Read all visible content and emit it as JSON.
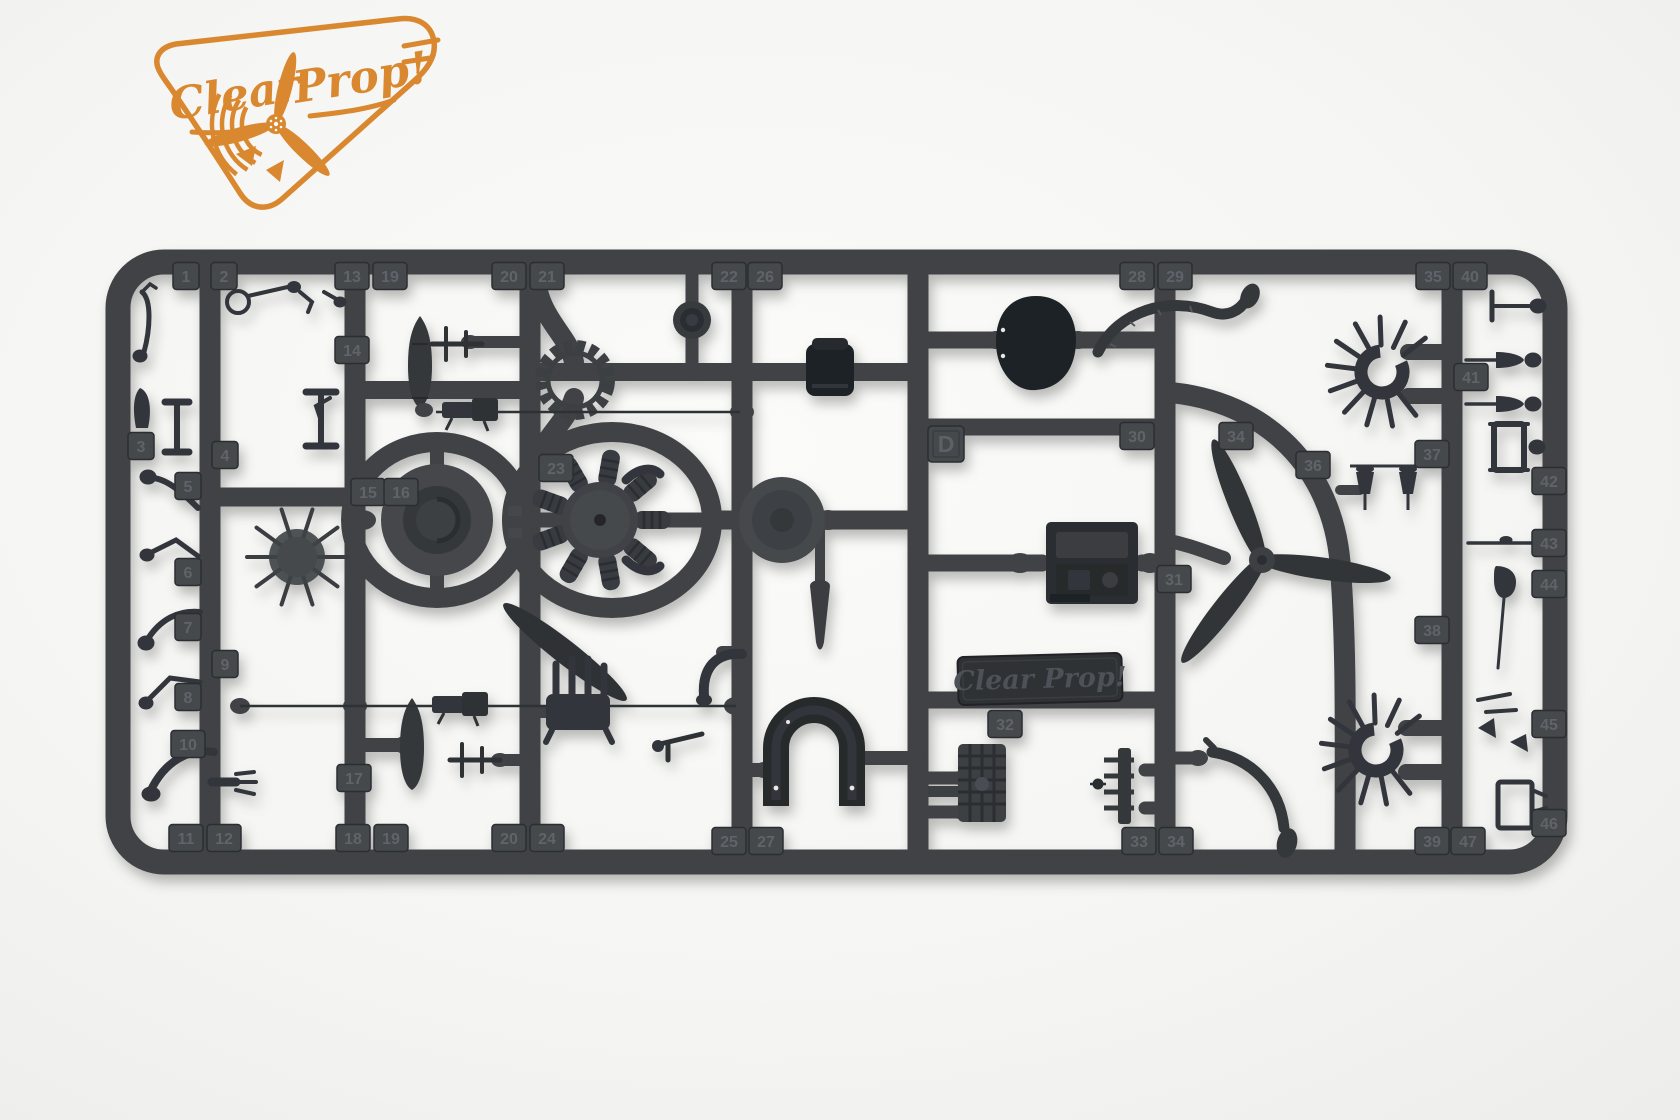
{
  "meta": {
    "image_type": "product-photo-model-kit-sprue"
  },
  "logo": {
    "word1": "Clear",
    "word2": "Prop!",
    "color": "#d9882f"
  },
  "sprue": {
    "letter": "D",
    "nameplate_text": "Clear Prop!",
    "tabs": [
      {
        "n": "1",
        "x": 186,
        "y": 276
      },
      {
        "n": "2",
        "x": 224,
        "y": 276
      },
      {
        "n": "13",
        "x": 352,
        "y": 276
      },
      {
        "n": "19",
        "x": 390,
        "y": 276
      },
      {
        "n": "20",
        "x": 509,
        "y": 276
      },
      {
        "n": "21",
        "x": 547,
        "y": 276
      },
      {
        "n": "22",
        "x": 729,
        "y": 276
      },
      {
        "n": "26",
        "x": 765,
        "y": 276
      },
      {
        "n": "28",
        "x": 1137,
        "y": 276
      },
      {
        "n": "29",
        "x": 1175,
        "y": 276
      },
      {
        "n": "35",
        "x": 1433,
        "y": 276
      },
      {
        "n": "40",
        "x": 1470,
        "y": 276
      },
      {
        "n": "3",
        "x": 141,
        "y": 446
      },
      {
        "n": "4",
        "x": 225,
        "y": 455
      },
      {
        "n": "5",
        "x": 188,
        "y": 486
      },
      {
        "n": "6",
        "x": 188,
        "y": 572
      },
      {
        "n": "7",
        "x": 188,
        "y": 627
      },
      {
        "n": "8",
        "x": 188,
        "y": 697
      },
      {
        "n": "9",
        "x": 225,
        "y": 664
      },
      {
        "n": "10",
        "x": 188,
        "y": 744
      },
      {
        "n": "11",
        "x": 186,
        "y": 838
      },
      {
        "n": "12",
        "x": 224,
        "y": 838
      },
      {
        "n": "14",
        "x": 352,
        "y": 350
      },
      {
        "n": "15",
        "x": 368,
        "y": 492
      },
      {
        "n": "16",
        "x": 401,
        "y": 492
      },
      {
        "n": "23",
        "x": 556,
        "y": 468
      },
      {
        "n": "17",
        "x": 354,
        "y": 778
      },
      {
        "n": "18",
        "x": 353,
        "y": 838
      },
      {
        "n": "19",
        "x": 391,
        "y": 838
      },
      {
        "n": "20",
        "x": 509,
        "y": 838
      },
      {
        "n": "24",
        "x": 547,
        "y": 838
      },
      {
        "n": "25",
        "x": 729,
        "y": 841
      },
      {
        "n": "27",
        "x": 766,
        "y": 841
      },
      {
        "n": "30",
        "x": 1137,
        "y": 436
      },
      {
        "n": "31",
        "x": 1174,
        "y": 579
      },
      {
        "n": "32",
        "x": 1005,
        "y": 724
      },
      {
        "n": "33",
        "x": 1139,
        "y": 841
      },
      {
        "n": "34",
        "x": 1176,
        "y": 841
      },
      {
        "n": "34",
        "x": 1236,
        "y": 436
      },
      {
        "n": "36",
        "x": 1313,
        "y": 465
      },
      {
        "n": "37",
        "x": 1432,
        "y": 454
      },
      {
        "n": "38",
        "x": 1432,
        "y": 630
      },
      {
        "n": "39",
        "x": 1432,
        "y": 841
      },
      {
        "n": "41",
        "x": 1471,
        "y": 377
      },
      {
        "n": "47",
        "x": 1468,
        "y": 841
      },
      {
        "n": "42",
        "x": 1549,
        "y": 481
      },
      {
        "n": "43",
        "x": 1549,
        "y": 543
      },
      {
        "n": "44",
        "x": 1549,
        "y": 584
      },
      {
        "n": "45",
        "x": 1549,
        "y": 724
      },
      {
        "n": "46",
        "x": 1549,
        "y": 823
      }
    ],
    "parts_visible": [
      "radial-engine",
      "cowling-ring",
      "propeller-3-blade",
      "propeller-blade-single",
      "engine-cowling-panel",
      "pilot-seat",
      "main-wheel",
      "cowl-flap-ring",
      "exhaust-collector-ring",
      "exhaust-collector-ring-2",
      "pushrod-ring",
      "bomb-fuel-tank",
      "bomb-fuel-tank-2",
      "machine-gun",
      "machine-gun-2",
      "engine-mount-box",
      "instrument-radiator-block",
      "nameplate",
      "horseshoe-cowl-front",
      "manifold",
      "windscreen-frame",
      "control-levers",
      "pitot-tubes",
      "struts"
    ]
  },
  "colors": {
    "background": "#f5f5f3",
    "plastic": "#3f4245",
    "plastic_dark": "#2b2e31",
    "dark_part": "#232629",
    "mid_part": "#33363a",
    "tab_fill": "#45484c",
    "tab_text": "#60646a",
    "logo_orange": "#d9882f",
    "nameplate_fill": "#2d3034"
  }
}
